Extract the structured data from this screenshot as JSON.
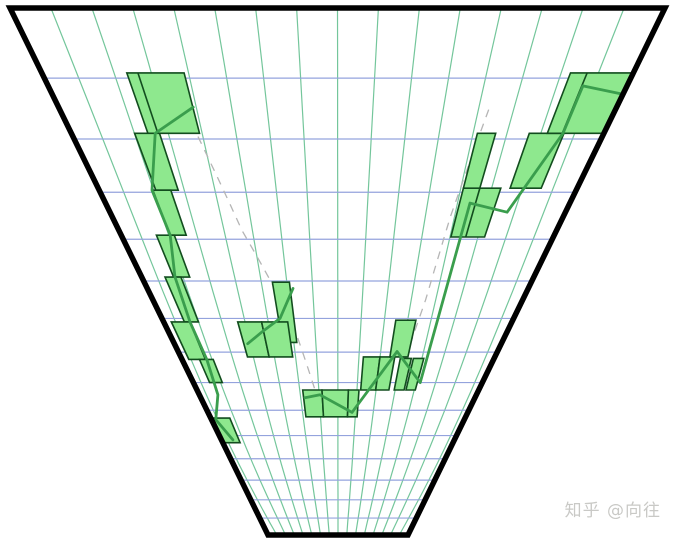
{
  "watermark": {
    "text": "知乎 @向往",
    "color": "#c9c9c6"
  },
  "chart_data": {
    "type": "candlestick-perspective",
    "description": "Candlestick chart projected onto a receding plane (inverted trapezoid funnel). Time columns converge toward a vanishing point below; price rows compress with depth. Price dips from upper-left to far bottom-center, then recovers to upper-right.",
    "frame": {
      "top_y": 8,
      "bottom_y": 535,
      "top_x_left": 10,
      "top_x_right": 665,
      "bottom_x_left": 268,
      "bottom_x_right": 408,
      "stroke_color": "#000000",
      "stroke_width": 5.5
    },
    "grid": {
      "columns": 16,
      "rows": 15,
      "depth_gain": 2.15,
      "depth_curve": 1.15,
      "vertical_bow_px": 12,
      "vertical_color": "#74c69b",
      "horizontal_color": "#94a3dd",
      "vertical_width": 1.2,
      "horizontal_width": 1.2
    },
    "style": {
      "background": "#ffffff",
      "candle_fill": "#8ee88e",
      "candle_stroke": "#124d1e",
      "candle_stroke_width": 1.6,
      "line_color": "#3a9e4d",
      "line_width": 2.8,
      "dashed_color": "#b5b5b5",
      "dashed_width": 1.3,
      "dash_pattern": "8 7"
    },
    "candles": [
      {
        "t0": 2.3,
        "t1": 3.85,
        "r0": 0.92,
        "r1": 1.9,
        "div": 2.6
      },
      {
        "t0": 1.9,
        "t1": 2.65,
        "r0": 1.9,
        "r1": 2.96
      },
      {
        "t0": 1.8,
        "t1": 2.4,
        "r0": 2.96,
        "r1": 3.91
      },
      {
        "t0": 1.3,
        "t1": 1.96,
        "r0": 3.91,
        "r1": 4.9
      },
      {
        "t0": 0.95,
        "t1": 1.6,
        "r0": 4.9,
        "r1": 6.1
      },
      {
        "t0": 0.35,
        "t1": 1.2,
        "r0": 6.1,
        "r1": 7.23
      },
      {
        "t0": 0.9,
        "t1": 1.6,
        "r0": 7.23,
        "r1": 8.0
      },
      {
        "t0": 0.0,
        "t1": 1.2,
        "r0": 9.3,
        "r1": 10.3
      },
      {
        "t0": 5.3,
        "t1": 6.0,
        "r0": 5.03,
        "r1": 6.7
      },
      {
        "t0": 3.4,
        "t1": 4.5,
        "r0": 6.1,
        "r1": 7.15
      },
      {
        "t0": 4.5,
        "t1": 5.7,
        "r0": 6.1,
        "r1": 7.15
      },
      {
        "t0": 6.0,
        "t1": 7.1,
        "r0": 8.26,
        "r1": 9.25
      },
      {
        "t0": 7.1,
        "t1": 8.6,
        "r0": 8.26,
        "r1": 9.25
      },
      {
        "t0": 8.6,
        "t1": 9.2,
        "r0": 8.26,
        "r1": 9.25
      },
      {
        "t0": 9.3,
        "t1": 10.15,
        "r0": 7.15,
        "r1": 8.26
      },
      {
        "t0": 10.15,
        "t1": 10.9,
        "r0": 7.15,
        "r1": 8.26
      },
      {
        "t0": 11.2,
        "t1": 11.76,
        "r0": 7.2,
        "r1": 8.26
      },
      {
        "t0": 11.87,
        "t1": 12.4,
        "r0": 7.2,
        "r1": 8.26
      },
      {
        "t0": 10.65,
        "t1": 11.57,
        "r0": 6.05,
        "r1": 7.15
      },
      {
        "t0": 12.2,
        "t1": 13.45,
        "r0": 2.92,
        "r1": 3.95,
        "div": 12.75
      },
      {
        "t0": 12.2,
        "t1": 12.75,
        "r0": 1.9,
        "r1": 2.92
      },
      {
        "t0": 13.76,
        "t1": 14.8,
        "r0": 1.9,
        "r1": 2.92
      },
      {
        "t0": 14.3,
        "t1": 16.0,
        "r0": 0.92,
        "r1": 1.9,
        "div": 14.75
      }
    ],
    "price_line": {
      "segments": [
        [
          [
            3.86,
            1.46
          ],
          [
            2.52,
            1.9
          ],
          [
            1.77,
            2.96
          ],
          [
            1.81,
            3.91
          ],
          [
            1.36,
            4.9
          ],
          [
            1.21,
            6.1
          ],
          [
            1.27,
            7.23
          ],
          [
            1.07,
            8.43
          ],
          [
            0.27,
            9.36
          ],
          [
            0.79,
            10.18
          ]
        ],
        [
          [
            6.12,
            5.19
          ],
          [
            5.37,
            6.0
          ],
          [
            4.44,
            6.38
          ],
          [
            3.59,
            6.74
          ]
        ],
        [
          [
            6.08,
            8.54
          ],
          [
            6.97,
            8.43
          ],
          [
            8.87,
            9.08
          ],
          [
            10.97,
            6.98
          ],
          [
            12.56,
            8.0
          ],
          [
            12.56,
            3.22
          ],
          [
            13.95,
            3.41
          ],
          [
            14.77,
            1.9
          ],
          [
            14.78,
            1.12
          ],
          [
            16.0,
            1.25
          ]
        ]
      ]
    },
    "dashed_guides": [
      [
        [
          3.6,
          1.5
        ],
        [
          4.5,
          3.8
        ],
        [
          5.9,
          6.1
        ],
        [
          6.9,
          8.8
        ]
      ],
      [
        [
          12.35,
          1.5
        ],
        [
          12.0,
          3.5
        ],
        [
          11.8,
          5.5
        ],
        [
          11.3,
          8.0
        ]
      ]
    ]
  }
}
